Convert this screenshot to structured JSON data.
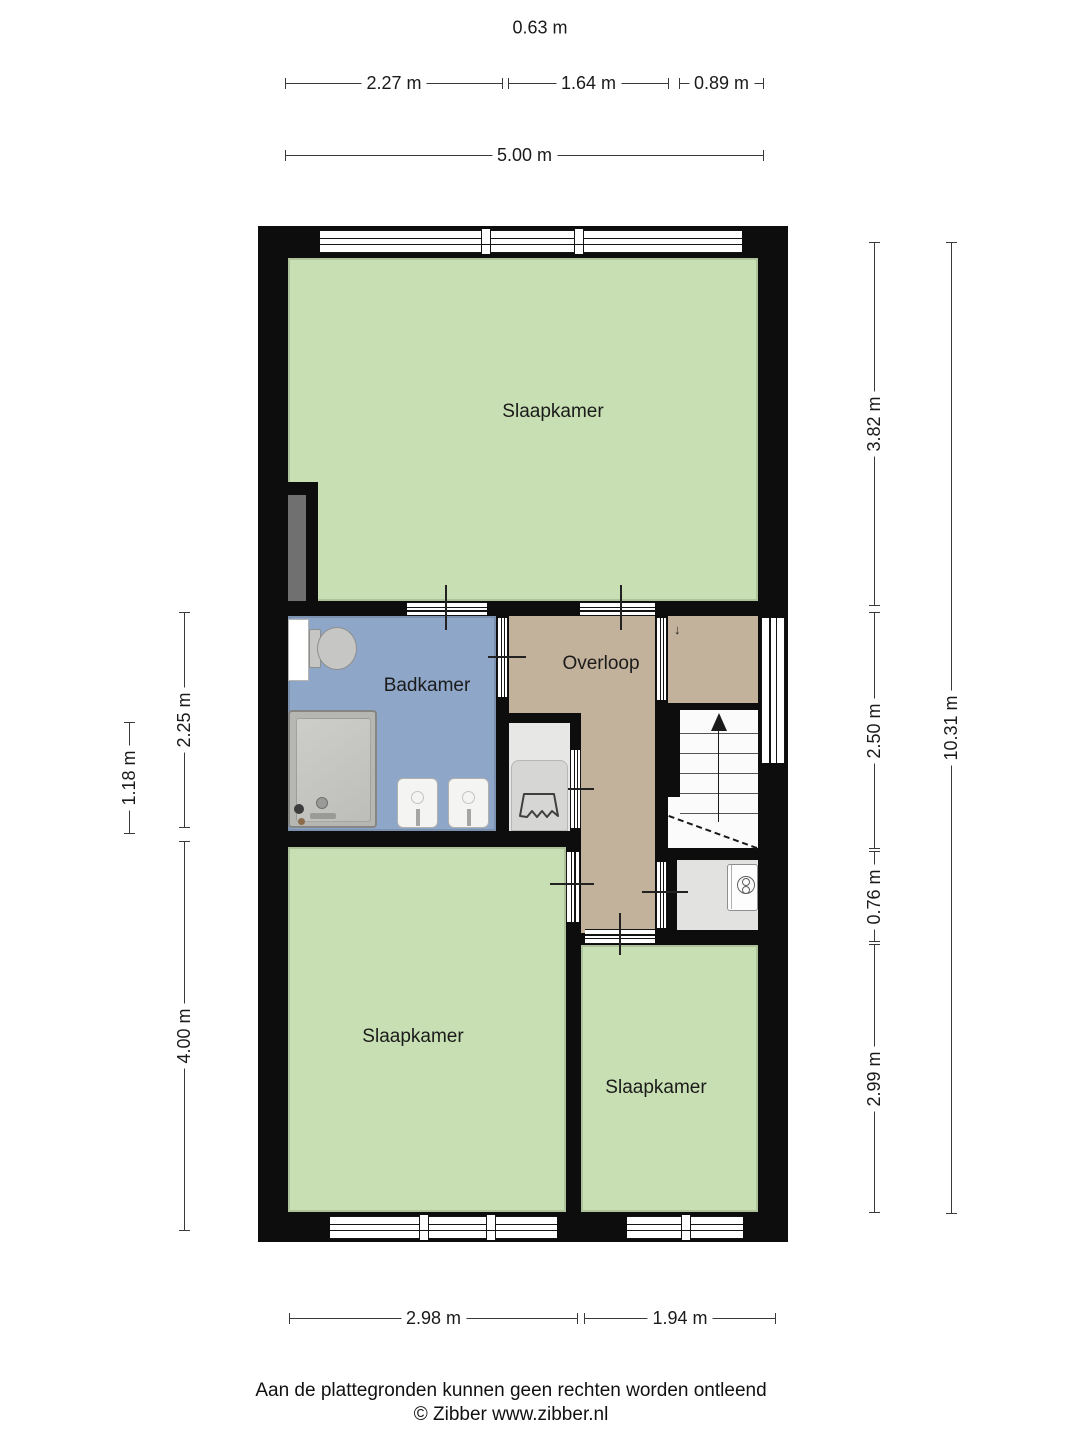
{
  "rooms": {
    "bedroom_top": "Slaapkamer",
    "bathroom": "Badkamer",
    "landing": "Overloop",
    "bedroom_left": "Slaapkamer",
    "bedroom_right": "Slaapkamer"
  },
  "dimensions": {
    "top_free": "0.63 m",
    "top_a": "2.27 m",
    "top_b": "1.64 m",
    "top_c": "0.89 m",
    "top_total": "5.00 m",
    "left_a": "2.25 m",
    "left_b": "1.18 m",
    "left_c": "4.00 m",
    "right_a": "3.82 m",
    "right_b": "2.50 m",
    "right_c": "0.76 m",
    "right_d": "2.99 m",
    "right_total": "10.31 m",
    "bottom_a": "2.98 m",
    "bottom_b": "1.94 m"
  },
  "stairs": {
    "direction_up_glyph": "↓"
  },
  "footer": {
    "disclaimer": "Aan de plattegronden kunnen geen rechten worden ontleend",
    "credit": "© Zibber www.zibber.nl"
  },
  "colors": {
    "wall": "#0d0d0d",
    "room_green": "#c7dfb2",
    "bathroom_blue": "#8ea6c8",
    "landing_tan": "#c2b19b",
    "closet_gray": "#e7e7e6",
    "boiler_gray": "#e2e2e1",
    "duct_gray": "#707070"
  }
}
